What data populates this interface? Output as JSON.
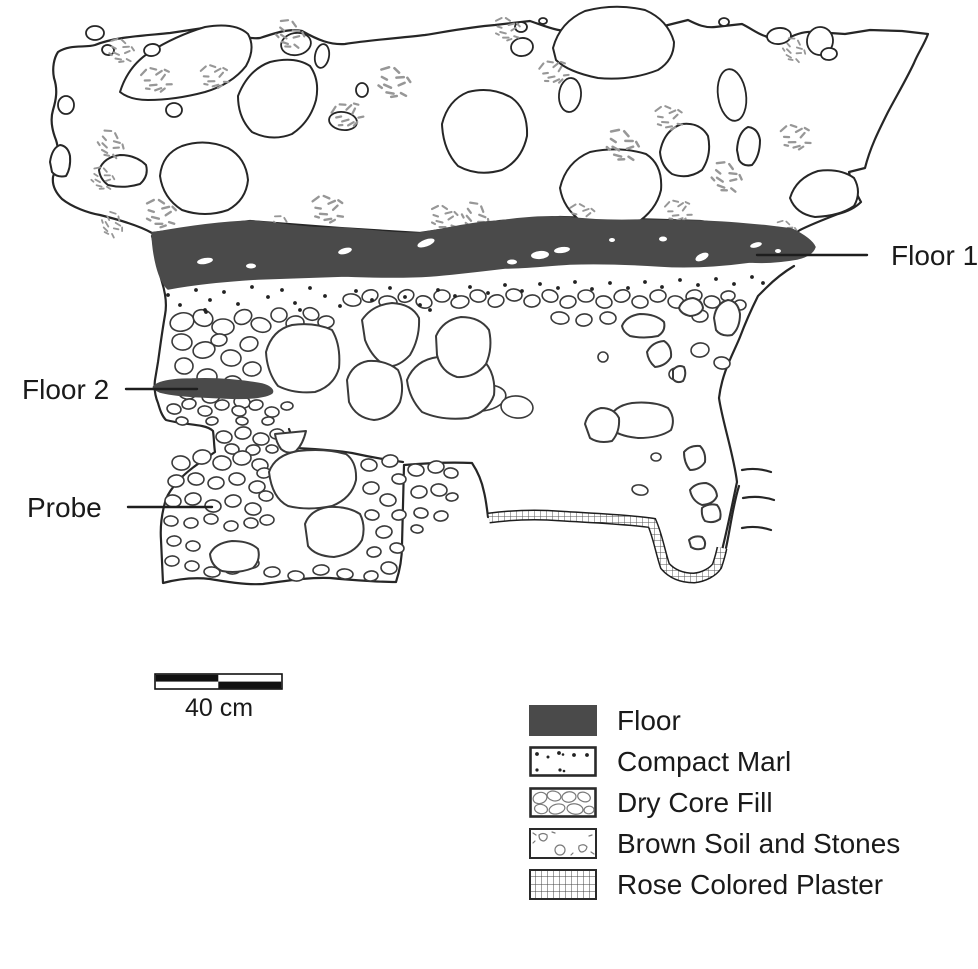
{
  "figure": {
    "type": "archaeological-section-drawing",
    "labels": {
      "floor1": "Floor 1",
      "floor2": "Floor 2",
      "probe": "Probe"
    },
    "scale_bar": {
      "label": "40 cm"
    },
    "legend": {
      "items": [
        {
          "key": "floor",
          "label": "Floor",
          "pattern": "solid-dark-fill"
        },
        {
          "key": "compact-marl",
          "label": "Compact Marl",
          "pattern": "scattered-dots"
        },
        {
          "key": "dry-core-fill",
          "label": "Dry Core Fill",
          "pattern": "packed-stone-outlines"
        },
        {
          "key": "brown-soil-and-stones",
          "label": "Brown Soil and Stones",
          "pattern": "sparse-stones-and-ticks"
        },
        {
          "key": "rose-colored-plaster",
          "label": "Rose Colored Plaster",
          "pattern": "grid"
        }
      ]
    },
    "colors": {
      "floor_fill": "#4a4a4a",
      "line": "#262626",
      "stone_line": "#3a3a3a",
      "speckle": "#979797",
      "background": "#ffffff"
    }
  }
}
